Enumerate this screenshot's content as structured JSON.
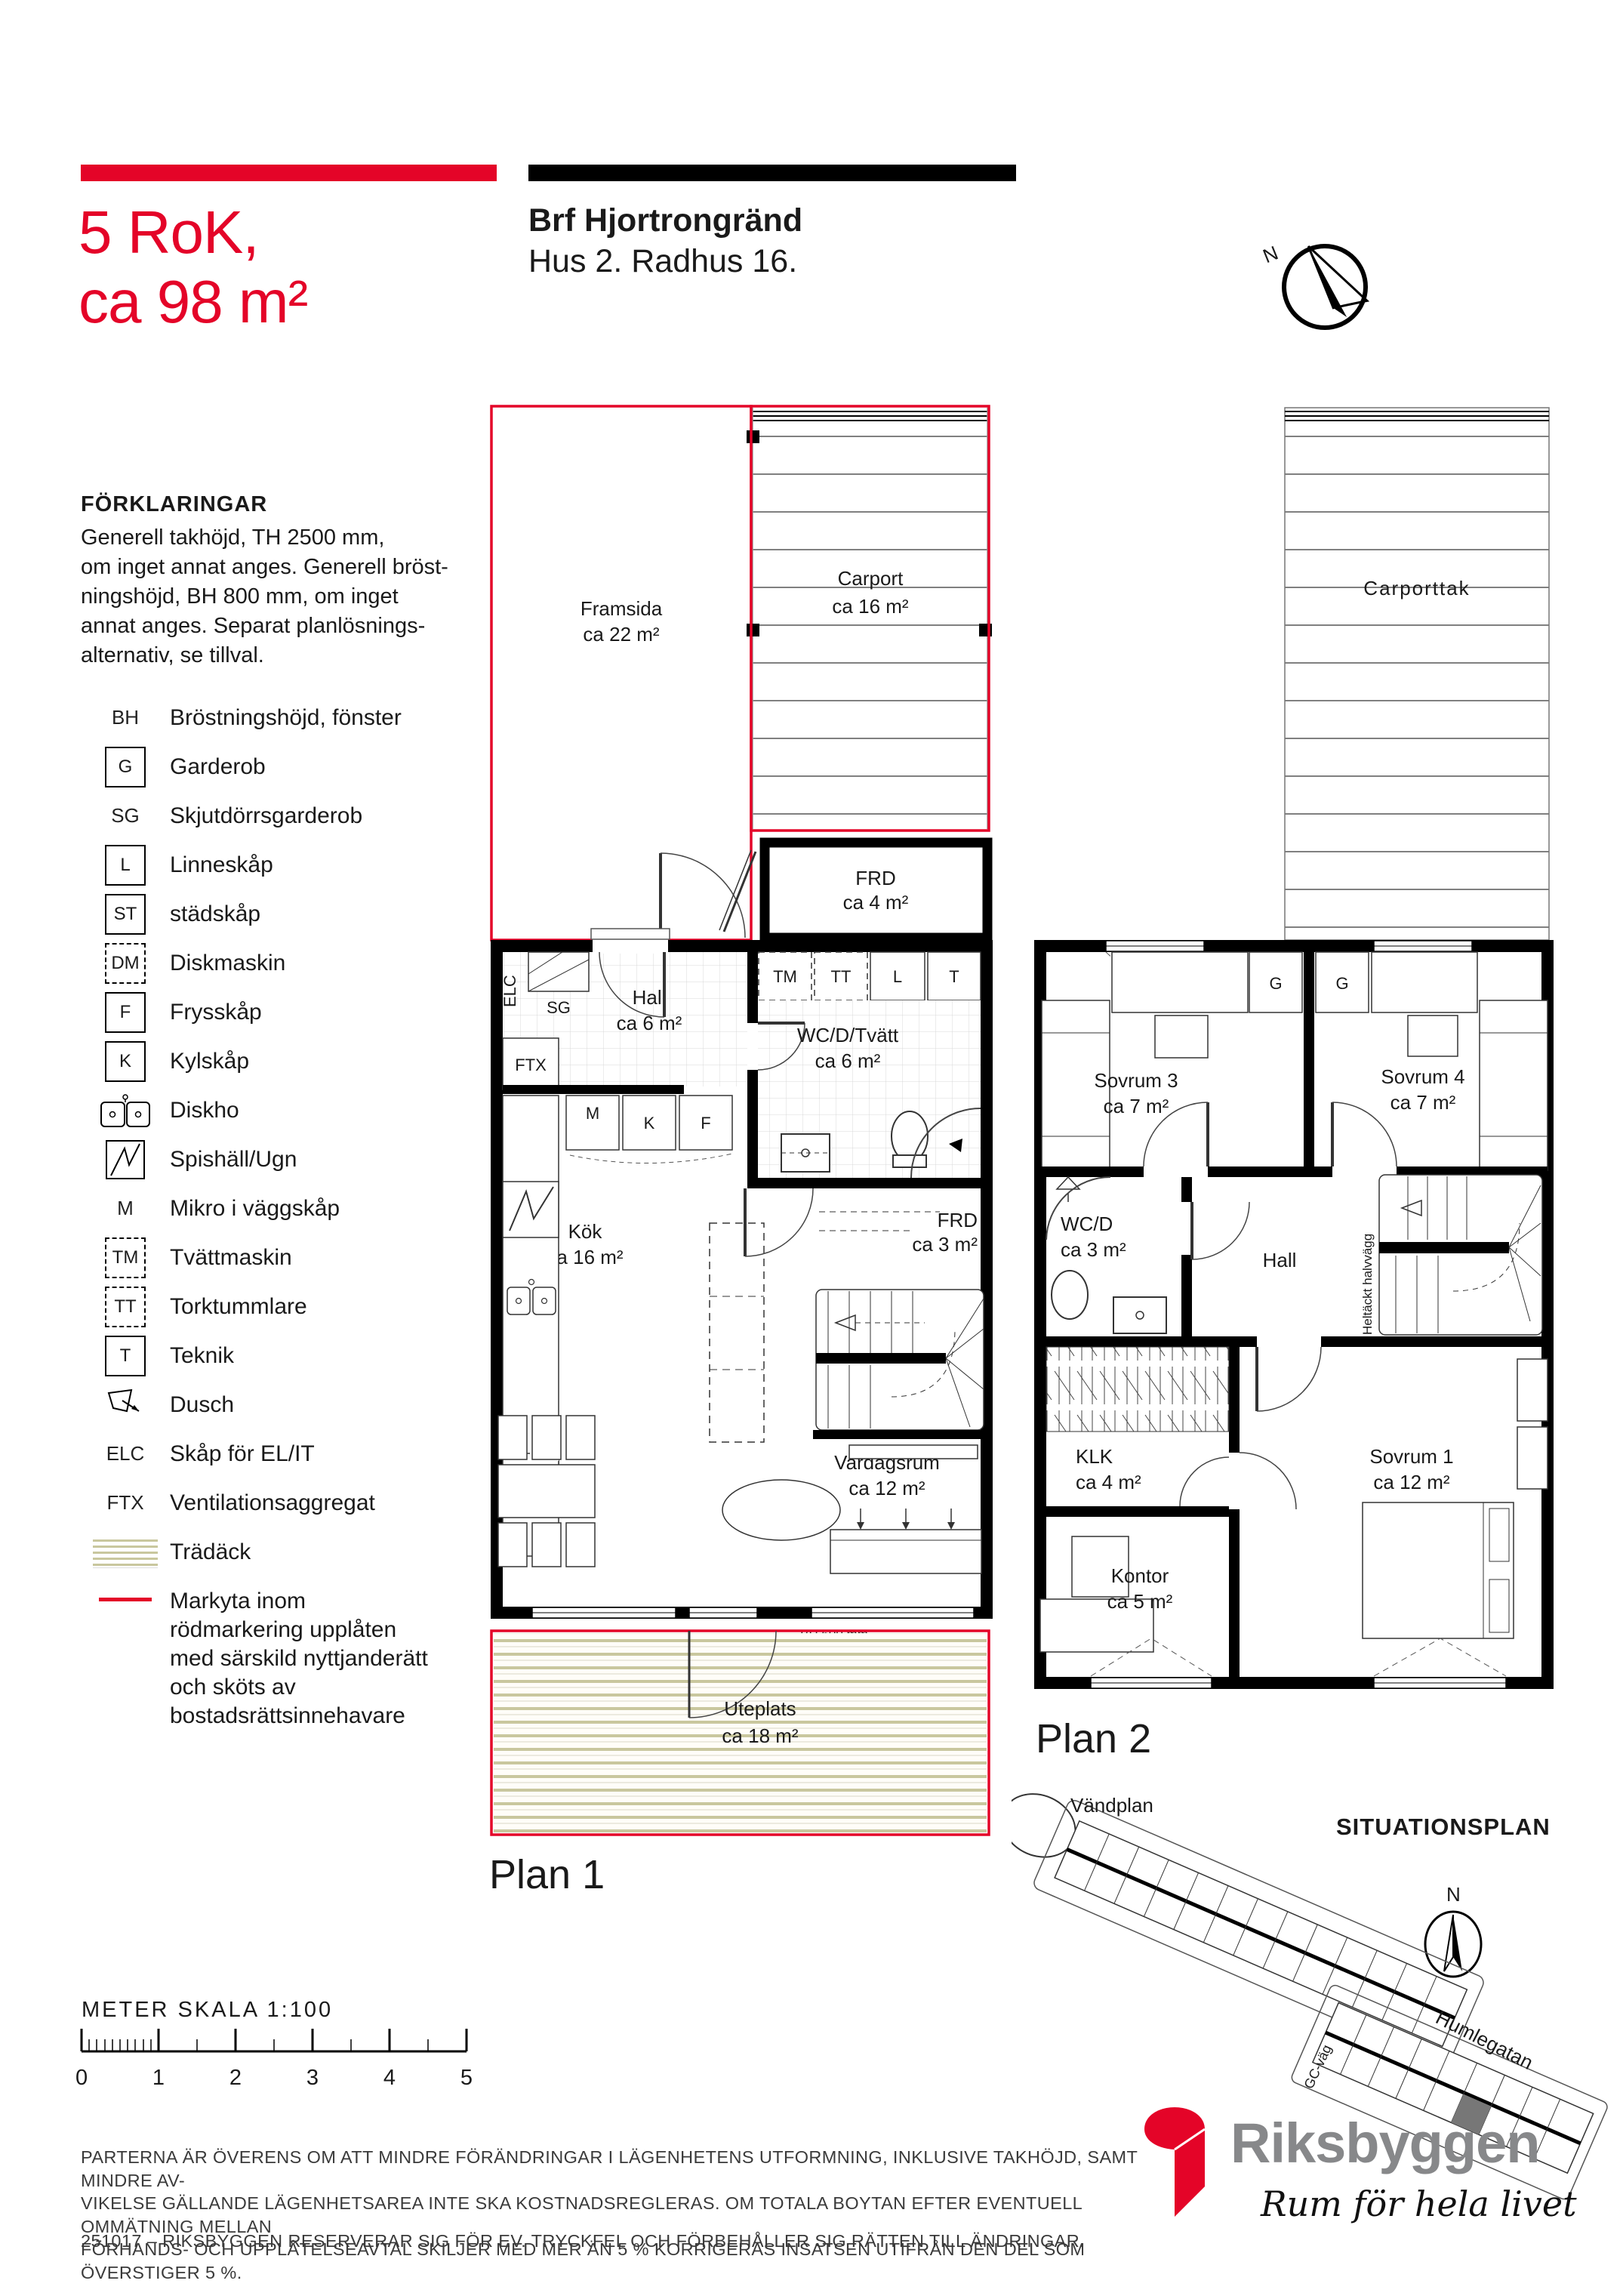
{
  "header": {
    "size_line1": "5 RoK,",
    "size_line2": "ca 98 m²",
    "project": "Brf Hjortrongränd",
    "unit": "Hus 2. Radhus 16.",
    "compass_n": "N"
  },
  "legend": {
    "title": "FÖRKLARINGAR",
    "description_lines": [
      "Generell takhöjd, TH 2500 mm,",
      "om inget annat anges. Generell bröst-",
      "ningshöjd, BH 800 mm, om inget",
      "annat anges. Separat planlösnings-",
      "alternativ, se tillval."
    ],
    "items": [
      {
        "symbol": "BH",
        "label": "Bröstningshöjd, fönster"
      },
      {
        "symbol": "G",
        "label": "Garderob"
      },
      {
        "symbol": "SG",
        "label": "Skjutdörrsgarderob"
      },
      {
        "symbol": "L",
        "label": "Linneskåp"
      },
      {
        "symbol": "ST",
        "label": "städskåp"
      },
      {
        "symbol": "DM",
        "label": "Diskmaskin"
      },
      {
        "symbol": "F",
        "label": "Frysskåp"
      },
      {
        "symbol": "K",
        "label": "Kylskåp"
      },
      {
        "symbol": "",
        "label": "Diskho"
      },
      {
        "symbol": "",
        "label": "Spishäll/Ugn"
      },
      {
        "symbol": "M",
        "label": "Mikro i väggskåp"
      },
      {
        "symbol": "TM",
        "label": "Tvättmaskin"
      },
      {
        "symbol": "TT",
        "label": "Torktummlare"
      },
      {
        "symbol": "T",
        "label": "Teknik"
      },
      {
        "symbol": "",
        "label": "Dusch"
      },
      {
        "symbol": "ELC",
        "label": "Skåp för EL/IT"
      },
      {
        "symbol": "FTX",
        "label": "Ventilationsaggregat"
      },
      {
        "symbol": "",
        "label": "Trädäck"
      },
      {
        "symbol": "",
        "label": "Markyta inom rödmarkering upplåten med särskild nyttjanderätt och sköts av bostadsrättsinnehavare"
      }
    ]
  },
  "plan1": {
    "label": "Plan 1",
    "rooms": {
      "framsida": {
        "name": "Framsida",
        "area": "ca 22 m²"
      },
      "carport": {
        "name": "Carport",
        "area": "ca 16 m²"
      },
      "frd_entre": {
        "name": "FRD",
        "area": "ca 4 m²"
      },
      "hall": {
        "name": "Hall",
        "area": "ca 6 m²"
      },
      "wc": {
        "name": "WC/D/Tvätt",
        "area": "ca 6 m²"
      },
      "kok": {
        "name": "Kök",
        "area": "ca 16 m²"
      },
      "frd_inner": {
        "name": "FRD",
        "area": "ca 3 m²"
      },
      "vardagsrum": {
        "name": "Vardagsrum",
        "area": "ca 12 m²"
      },
      "uteplats": {
        "name": "Uteplats",
        "area": "ca 18 m²"
      }
    },
    "tags": {
      "tm": "TM",
      "tt": "TT",
      "l": "L",
      "t": "T",
      "sg": "SG",
      "elc": "ELC",
      "ftx": "FTX",
      "m": "M",
      "k": "K",
      "f": "F",
      "dm": "DM"
    },
    "bh_label": "BH 600 mm"
  },
  "plan2": {
    "label": "Plan 2",
    "carporttak": "Carporttak",
    "rooms": {
      "sovrum3": {
        "name": "Sovrum 3",
        "area": "ca 7 m²"
      },
      "sovrum4": {
        "name": "Sovrum 4",
        "area": "ca 7 m²"
      },
      "wcd": {
        "name": "WC/D",
        "area": "ca 3 m²"
      },
      "hall": {
        "name": "Hall",
        "area": ""
      },
      "klk": {
        "name": "KLK",
        "area": "ca 4 m²"
      },
      "kontor": {
        "name": "Kontor",
        "area": "ca 5 m²"
      },
      "sovrum1": {
        "name": "Sovrum 1",
        "area": "ca 12 m²"
      }
    },
    "tags": {
      "g1": "G",
      "g2": "G"
    },
    "halvvagg": "Heltäckt halvvägg"
  },
  "situationsplan": {
    "title": "SITUATIONSPLAN",
    "vandplan": "Vändplan",
    "street": "Humlegatan",
    "gc_vag": "GC-väg",
    "compass_n": "N"
  },
  "scale": {
    "label": "METER  SKALA 1:100",
    "ticks": [
      "0",
      "1",
      "2",
      "3",
      "4",
      "5"
    ]
  },
  "footer": {
    "lines": [
      "PARTERNA ÄR ÖVERENS OM ATT MINDRE FÖRÄNDRINGAR I LÄGENHETENS UTFORMNING, INKLUSIVE TAKHÖJD, SAMT MINDRE AV-",
      "VIKELSE GÄLLANDE LÄGENHETSAREA INTE SKA KOSTNADSREGLERAS. OM TOTALA BOYTAN EFTER EVENTUELL OMMÄTNING MELLAN",
      "FÖRHANDS- OCH UPPLÅTELSEAVTAL SKILJER MED MER ÄN 5 % KORRIGERAS INSATSEN UTIFRÅN DEN DEL SOM ÖVERSTIGER 5 %."
    ],
    "note": "251017 – RIKSBYGGEN RESERVERAR SIG FÖR EV. TRYCKFEL OCH FÖRBEHÅLLER SIG RÄTTEN TILL ÄNDRINGAR."
  },
  "logo": {
    "name": "Riksbyggen",
    "tagline": "Rum för hela livet"
  },
  "colors": {
    "accent_red": "#e40428",
    "logo_gray": "#87888a",
    "deck_stripe": "#c9c79e",
    "highlight_plot": "#777777"
  }
}
